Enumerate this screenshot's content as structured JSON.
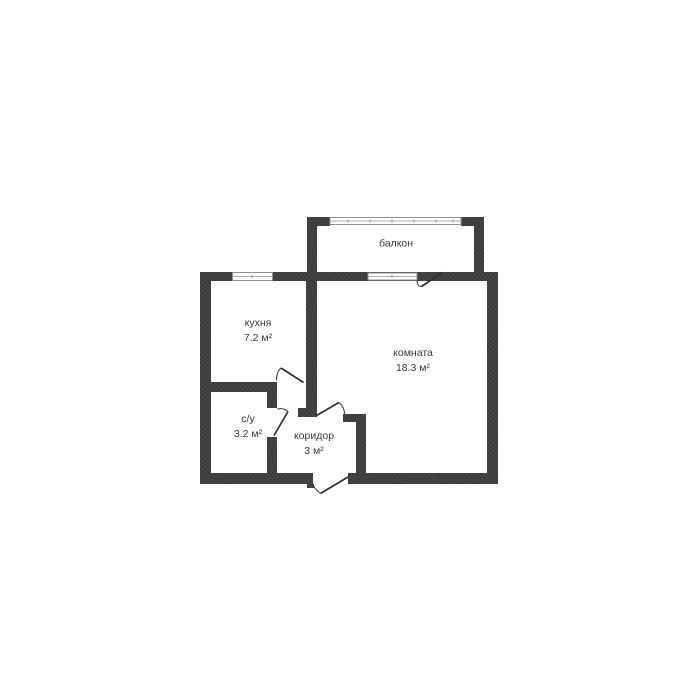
{
  "plan": {
    "type": "apartment-floor-plan",
    "rooms": [
      {
        "label": "балкон",
        "area": ""
      },
      {
        "label": "кухня",
        "area": "7.2 м²"
      },
      {
        "label": "комната",
        "area": "18.3 м²"
      },
      {
        "label": "с/у",
        "area": "3.2 м²"
      },
      {
        "label": "коридор",
        "area": "3 м²"
      }
    ],
    "colors": {
      "wall": "#3b3b3d",
      "text": "#3a3a3a",
      "window_stroke": "#8f8f8f",
      "door_stroke": "#2f2f2f",
      "background": "#ffffff"
    }
  }
}
